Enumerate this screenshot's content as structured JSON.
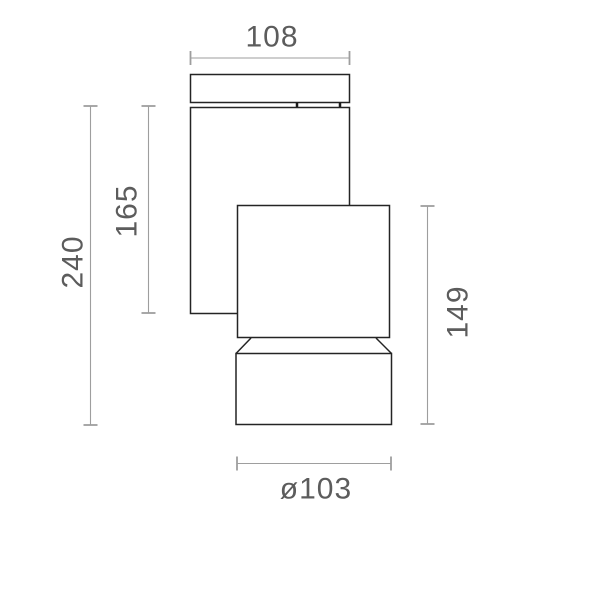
{
  "drawing": {
    "labels": {
      "top_width": "108",
      "overall_height": "240",
      "arm_height": "165",
      "head_height": "149",
      "head_diameter": "ø103"
    },
    "colors": {
      "object_line": "#242424",
      "dimension_line": "#9e9e9e",
      "label_text": "#5c5c5c",
      "background": "#ffffff"
    }
  }
}
